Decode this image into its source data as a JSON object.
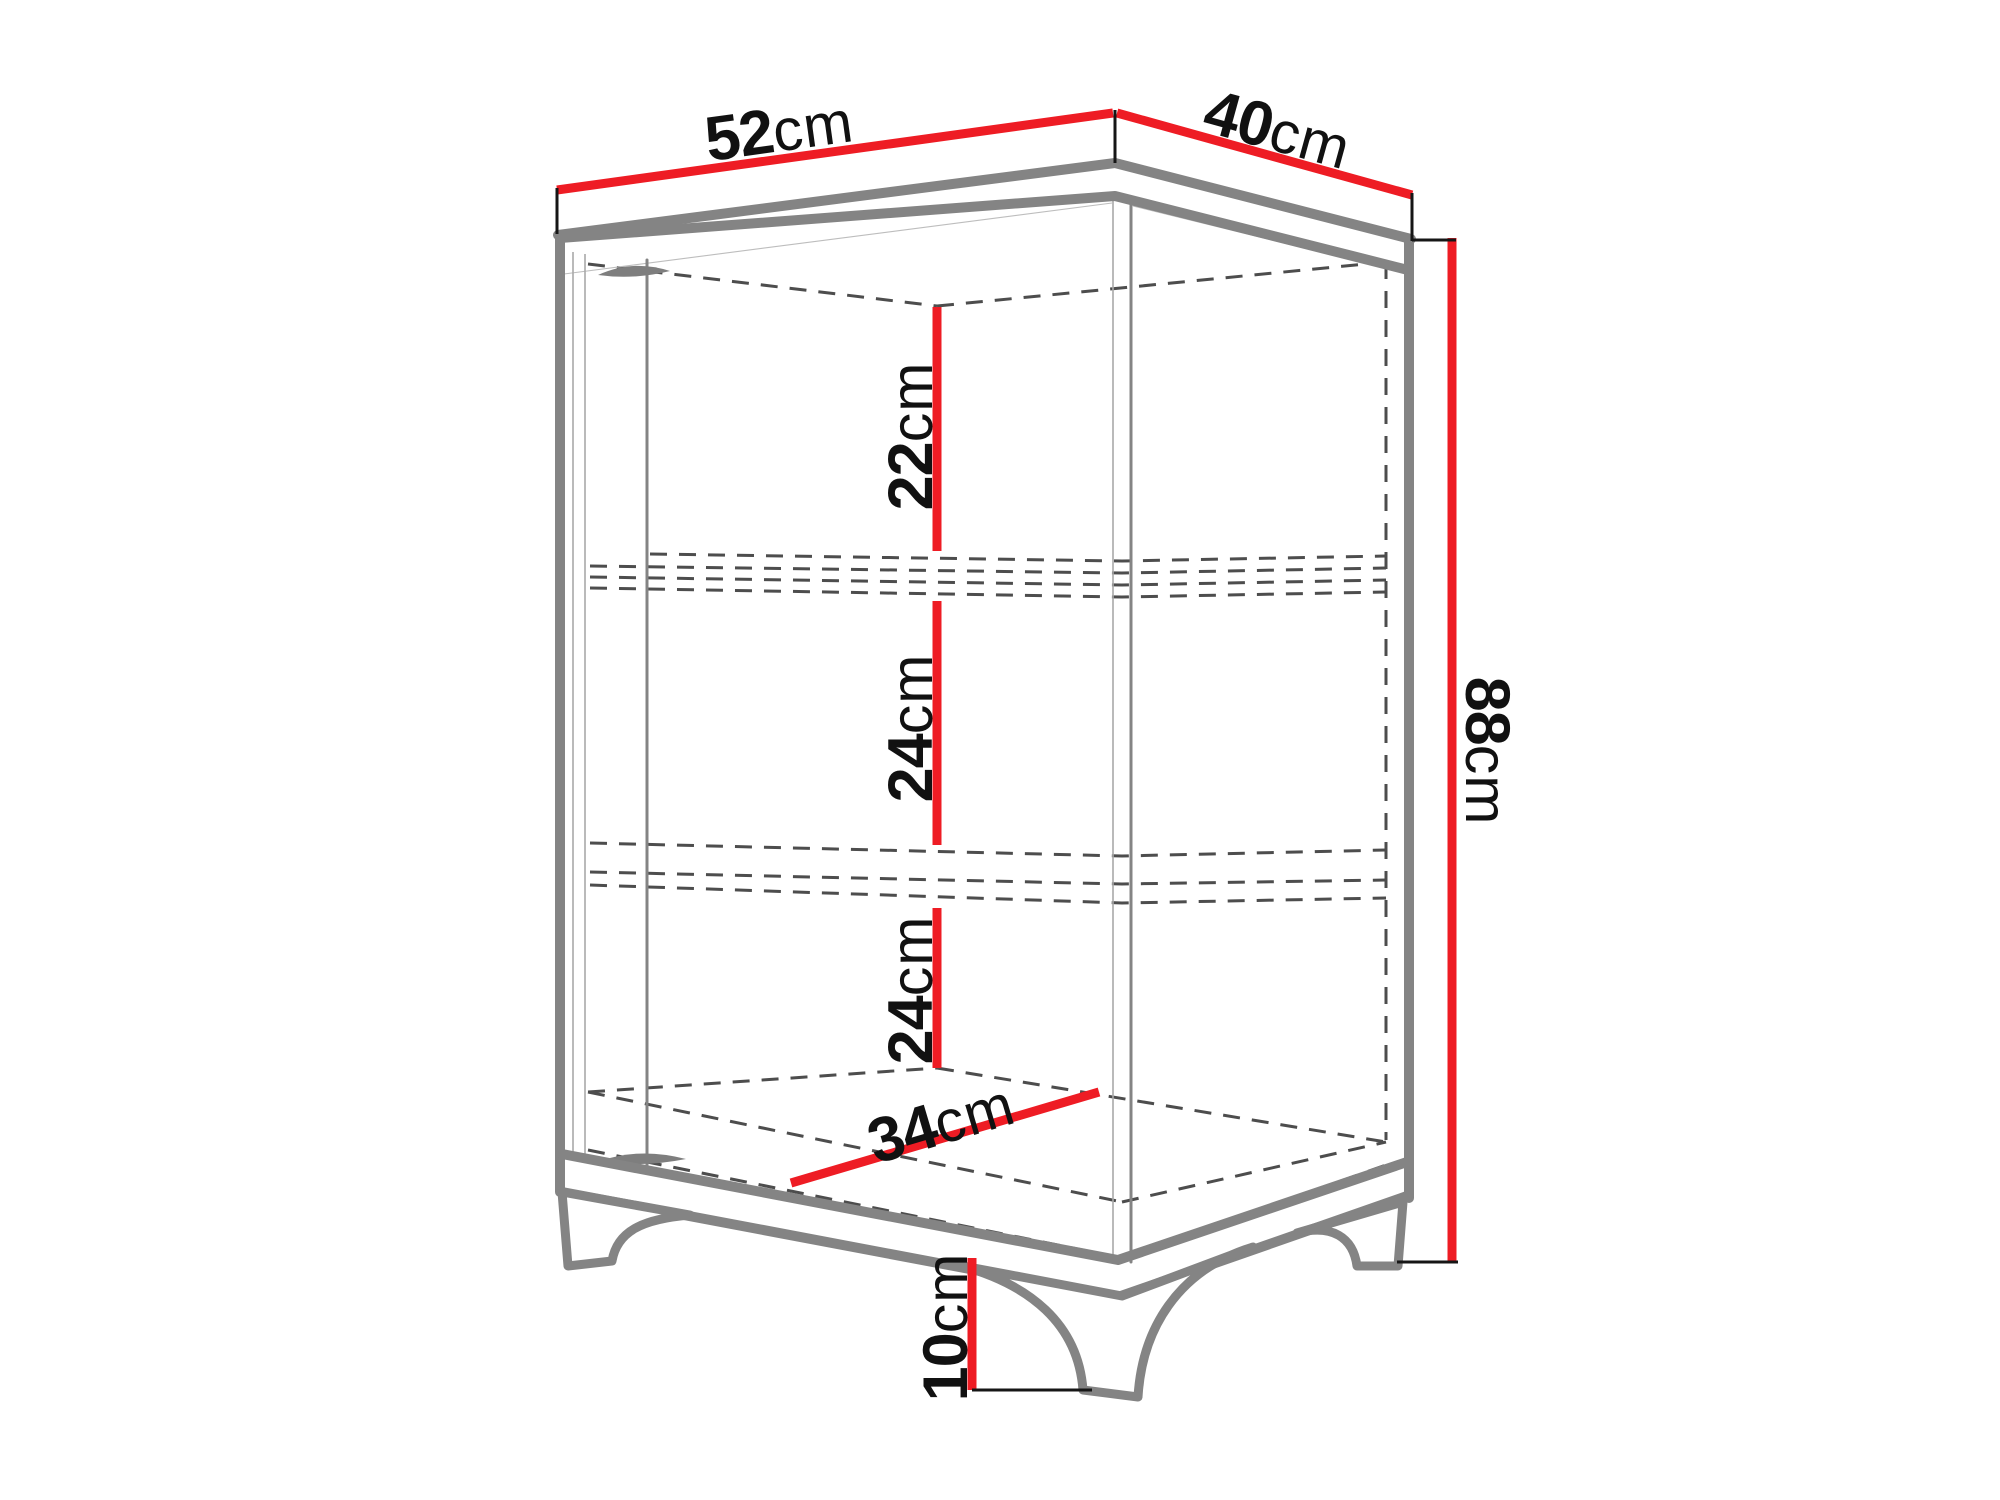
{
  "figure": {
    "kind": "furniture-dimension-diagram",
    "subject": "corner display cabinet with two shelves and curved legs",
    "unit": "cm"
  },
  "colors": {
    "dimension_line": "#ee1c24",
    "outline": "#848484",
    "hidden_line": "#4d4d4d",
    "tick": "#161616",
    "label_text": "#111111",
    "background": "#ffffff"
  },
  "dimensions": {
    "top_width": {
      "value": "52",
      "unit": "cm",
      "meaning": "top panel width (left edge)"
    },
    "top_depth": {
      "value": "40",
      "unit": "cm",
      "meaning": "top panel depth (right edge)"
    },
    "height": {
      "value": "88",
      "unit": "cm",
      "meaning": "overall height"
    },
    "section_top": {
      "value": "22",
      "unit": "cm",
      "meaning": "top interior section height"
    },
    "section_middle": {
      "value": "24",
      "unit": "cm",
      "meaning": "middle interior section height"
    },
    "section_bottom": {
      "value": "24",
      "unit": "cm",
      "meaning": "bottom interior section height"
    },
    "floor_diagonal": {
      "value": "34",
      "unit": "cm",
      "meaning": "interior floor depth"
    },
    "leg_height": {
      "value": "10",
      "unit": "cm",
      "meaning": "leg height"
    }
  }
}
